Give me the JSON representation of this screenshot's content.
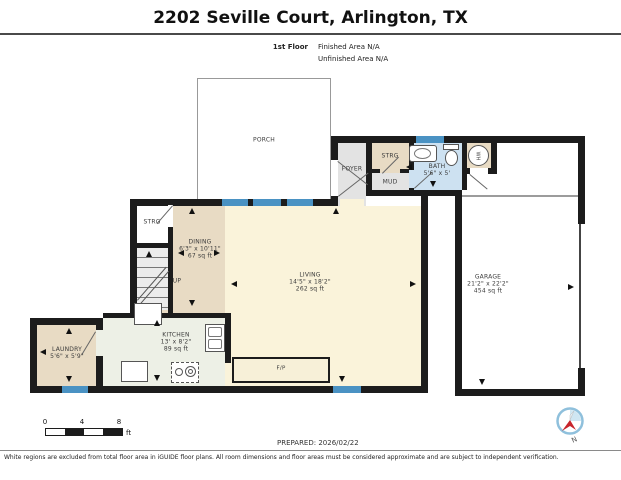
{
  "header": {
    "title": "2202 Seville Court, Arlington, TX",
    "floor_label": "1st Floor",
    "finished_area": "Finished Area N/A",
    "unfinished_area": "Unfinished Area N/A"
  },
  "rooms": {
    "porch": {
      "label": "PORCH"
    },
    "foyer": {
      "label": "FOYER"
    },
    "strg_top": {
      "label": "STRG"
    },
    "mud": {
      "label": "MUD"
    },
    "bath": {
      "label": "BATH",
      "dims": "5'6\" x 5'"
    },
    "wh": {
      "label": "WH"
    },
    "garage": {
      "label": "GARAGE",
      "dims": "21'2\" x 22'2\"",
      "area": "454 sq ft"
    },
    "living": {
      "label": "LIVING",
      "dims": "14'5\" x 18'2\"",
      "area": "262 sq ft"
    },
    "dining": {
      "label": "DINING",
      "dims": "6'3\" x 10'11\"",
      "area": "67 sq ft"
    },
    "kitchen": {
      "label": "KITCHEN",
      "dims": "13' x 8'2\"",
      "area": "89 sq ft"
    },
    "laundry": {
      "label": "LAUNDRY",
      "dims": "5'6\" x 5'9\""
    },
    "strg_left": {
      "label": "STRG"
    },
    "stairs": {
      "label": "UP"
    },
    "fireplace": {
      "label": "F/P"
    }
  },
  "scale_bar": {
    "ticks": [
      "0",
      "4",
      "8"
    ],
    "unit": "ft"
  },
  "footer": {
    "prepared": "PREPARED: 2026/02/22",
    "disclaimer": "White regions are excluded from total floor area in iGUIDE floor plans. All room dimensions and floor areas must be considered approximate and are subject to independent verification.",
    "compass_label": "N"
  },
  "colors": {
    "wall": "#1c1c1c",
    "window": "#4a92c3",
    "tan_room": "#e8dbc4",
    "living_room": "#faf3da",
    "kitchen_room": "#edf0e6",
    "gray_room": "#e3e3e3",
    "bath_room": "#cde1f1",
    "compass_ring": "#8fc0dc",
    "compass_needle": "#c8252c"
  }
}
